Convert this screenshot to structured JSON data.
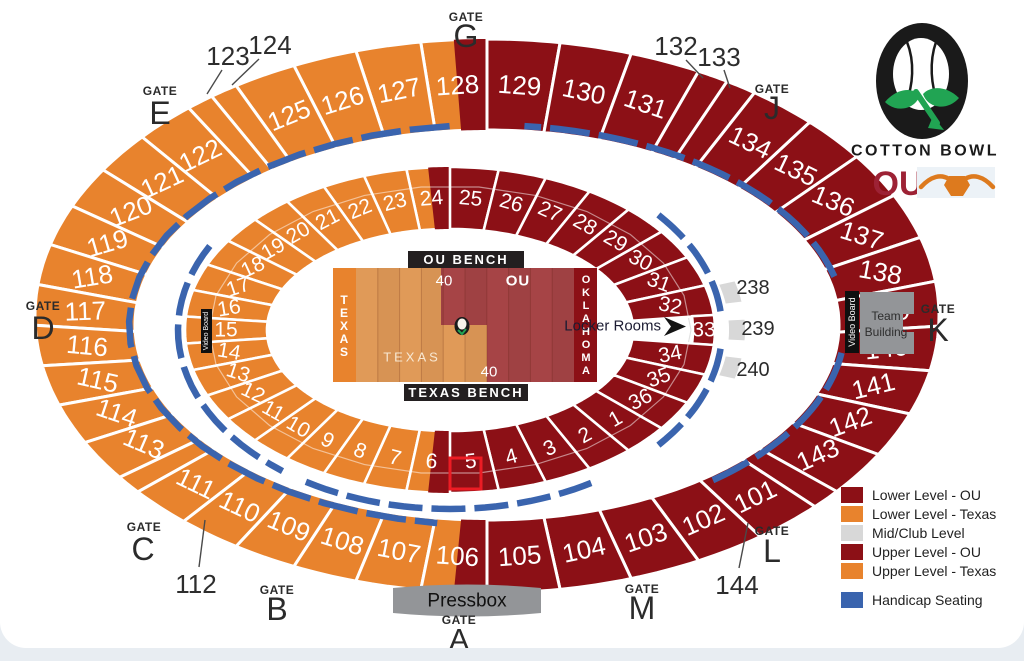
{
  "colors": {
    "texas_orange": "#E8832D",
    "ou_red": "#8C1016",
    "field_texas": "#E09A58",
    "field_ou": "#A64446",
    "mid_gray": "#D8D8D8",
    "handicap_blue": "#3A64AE",
    "building_gray": "#939598",
    "bench_black": "#231F20",
    "highlight_red": "#EC1C24",
    "logo_green": "#21A453",
    "logo_black": "#1A1A1A",
    "ou_crimson": "#9D2235",
    "longhorn_orange": "#DD7A1E"
  },
  "stadium": {
    "outer_left": [
      {
        "n": "128",
        "split": "start"
      },
      {
        "n": "127"
      },
      {
        "n": "126"
      },
      {
        "n": "125"
      },
      {
        "n": "124",
        "narrow": true,
        "out": true
      },
      {
        "n": "123",
        "narrow": true,
        "out": true
      },
      {
        "n": "122"
      },
      {
        "n": "121"
      },
      {
        "n": "120"
      },
      {
        "n": "119"
      },
      {
        "n": "118"
      },
      {
        "n": "117"
      },
      {
        "n": "116"
      },
      {
        "n": "115"
      },
      {
        "n": "114"
      },
      {
        "n": "113"
      },
      {
        "n": "112",
        "narrow": true,
        "out": true
      },
      {
        "n": "111"
      },
      {
        "n": "110"
      },
      {
        "n": "109"
      },
      {
        "n": "108"
      },
      {
        "n": "107"
      },
      {
        "n": "106",
        "split": "end"
      }
    ],
    "outer_right": [
      {
        "n": "129"
      },
      {
        "n": "130"
      },
      {
        "n": "131"
      },
      {
        "n": "132",
        "narrow": true,
        "out": true
      },
      {
        "n": "133",
        "narrow": true,
        "out": true
      },
      {
        "n": "134"
      },
      {
        "n": "135"
      },
      {
        "n": "136"
      },
      {
        "n": "137"
      },
      {
        "n": "138"
      },
      {
        "n": "139"
      },
      {
        "n": "140"
      },
      {
        "n": "141"
      },
      {
        "n": "142"
      },
      {
        "n": "143"
      },
      {
        "n": "144",
        "narrow": true,
        "out": true
      },
      {
        "n": "101"
      },
      {
        "n": "102"
      },
      {
        "n": "103"
      },
      {
        "n": "104"
      },
      {
        "n": "105"
      }
    ],
    "inner_left": [
      {
        "n": "24",
        "split": "start"
      },
      {
        "n": "23"
      },
      {
        "n": "22"
      },
      {
        "n": "21"
      },
      {
        "n": "20"
      },
      {
        "n": "19"
      },
      {
        "n": "18"
      },
      {
        "n": "17"
      },
      {
        "n": "16"
      },
      {
        "n": "15"
      },
      {
        "n": "14"
      },
      {
        "n": "13"
      },
      {
        "n": "12"
      },
      {
        "n": "11"
      },
      {
        "n": "10"
      },
      {
        "n": "9"
      },
      {
        "n": "8"
      },
      {
        "n": "7"
      },
      {
        "n": "6",
        "split": "end"
      }
    ],
    "inner_right": [
      {
        "n": "25"
      },
      {
        "n": "26"
      },
      {
        "n": "27"
      },
      {
        "n": "28"
      },
      {
        "n": "29"
      },
      {
        "n": "30"
      },
      {
        "n": "31"
      },
      {
        "n": "32"
      },
      {
        "n": "33",
        "tunnel": true
      },
      {
        "n": "34"
      },
      {
        "n": "35"
      },
      {
        "n": "36"
      },
      {
        "n": "1"
      },
      {
        "n": "2"
      },
      {
        "n": "3"
      },
      {
        "n": "4"
      },
      {
        "n": "5"
      }
    ],
    "mid_sections": [
      {
        "n": "238"
      },
      {
        "n": "239"
      },
      {
        "n": "240"
      }
    ]
  },
  "gates": {
    "word": "GATE",
    "letters": [
      "G",
      "E",
      "D",
      "C",
      "B",
      "A",
      "M",
      "L",
      "K",
      "J"
    ]
  },
  "field": {
    "left_endzone": "TEXAS",
    "right_endzone": "OKLAHOMA",
    "texas_label": "TEXAS",
    "ou_label": "OU",
    "yard_top": "40",
    "yard_bottom": "40",
    "ou_bench": "OU BENCH",
    "texas_bench": "TEXAS BENCH"
  },
  "labels": {
    "locker_rooms": "Locker Rooms",
    "pressbox": "Pressbox",
    "team_building_line1": "Team",
    "team_building_line2": "Building",
    "video_board": "Video Board"
  },
  "legend": {
    "items": [
      {
        "label": "Lower Level - OU",
        "color": "#8C1016",
        "gap_before": false
      },
      {
        "label": "Lower Level - Texas",
        "color": "#E8832D",
        "gap_before": false
      },
      {
        "label": "Mid/Club Level",
        "color": "#D8D8D8",
        "gap_before": false
      },
      {
        "label": "Upper Level - OU",
        "color": "#8C1016",
        "gap_before": false
      },
      {
        "label": "Upper Level - Texas",
        "color": "#E8832D",
        "gap_before": false
      },
      {
        "label": "Handicap Seating",
        "color": "#3A64AE",
        "gap_before": true
      }
    ]
  },
  "logo": {
    "title": "COTTON BOWL"
  }
}
